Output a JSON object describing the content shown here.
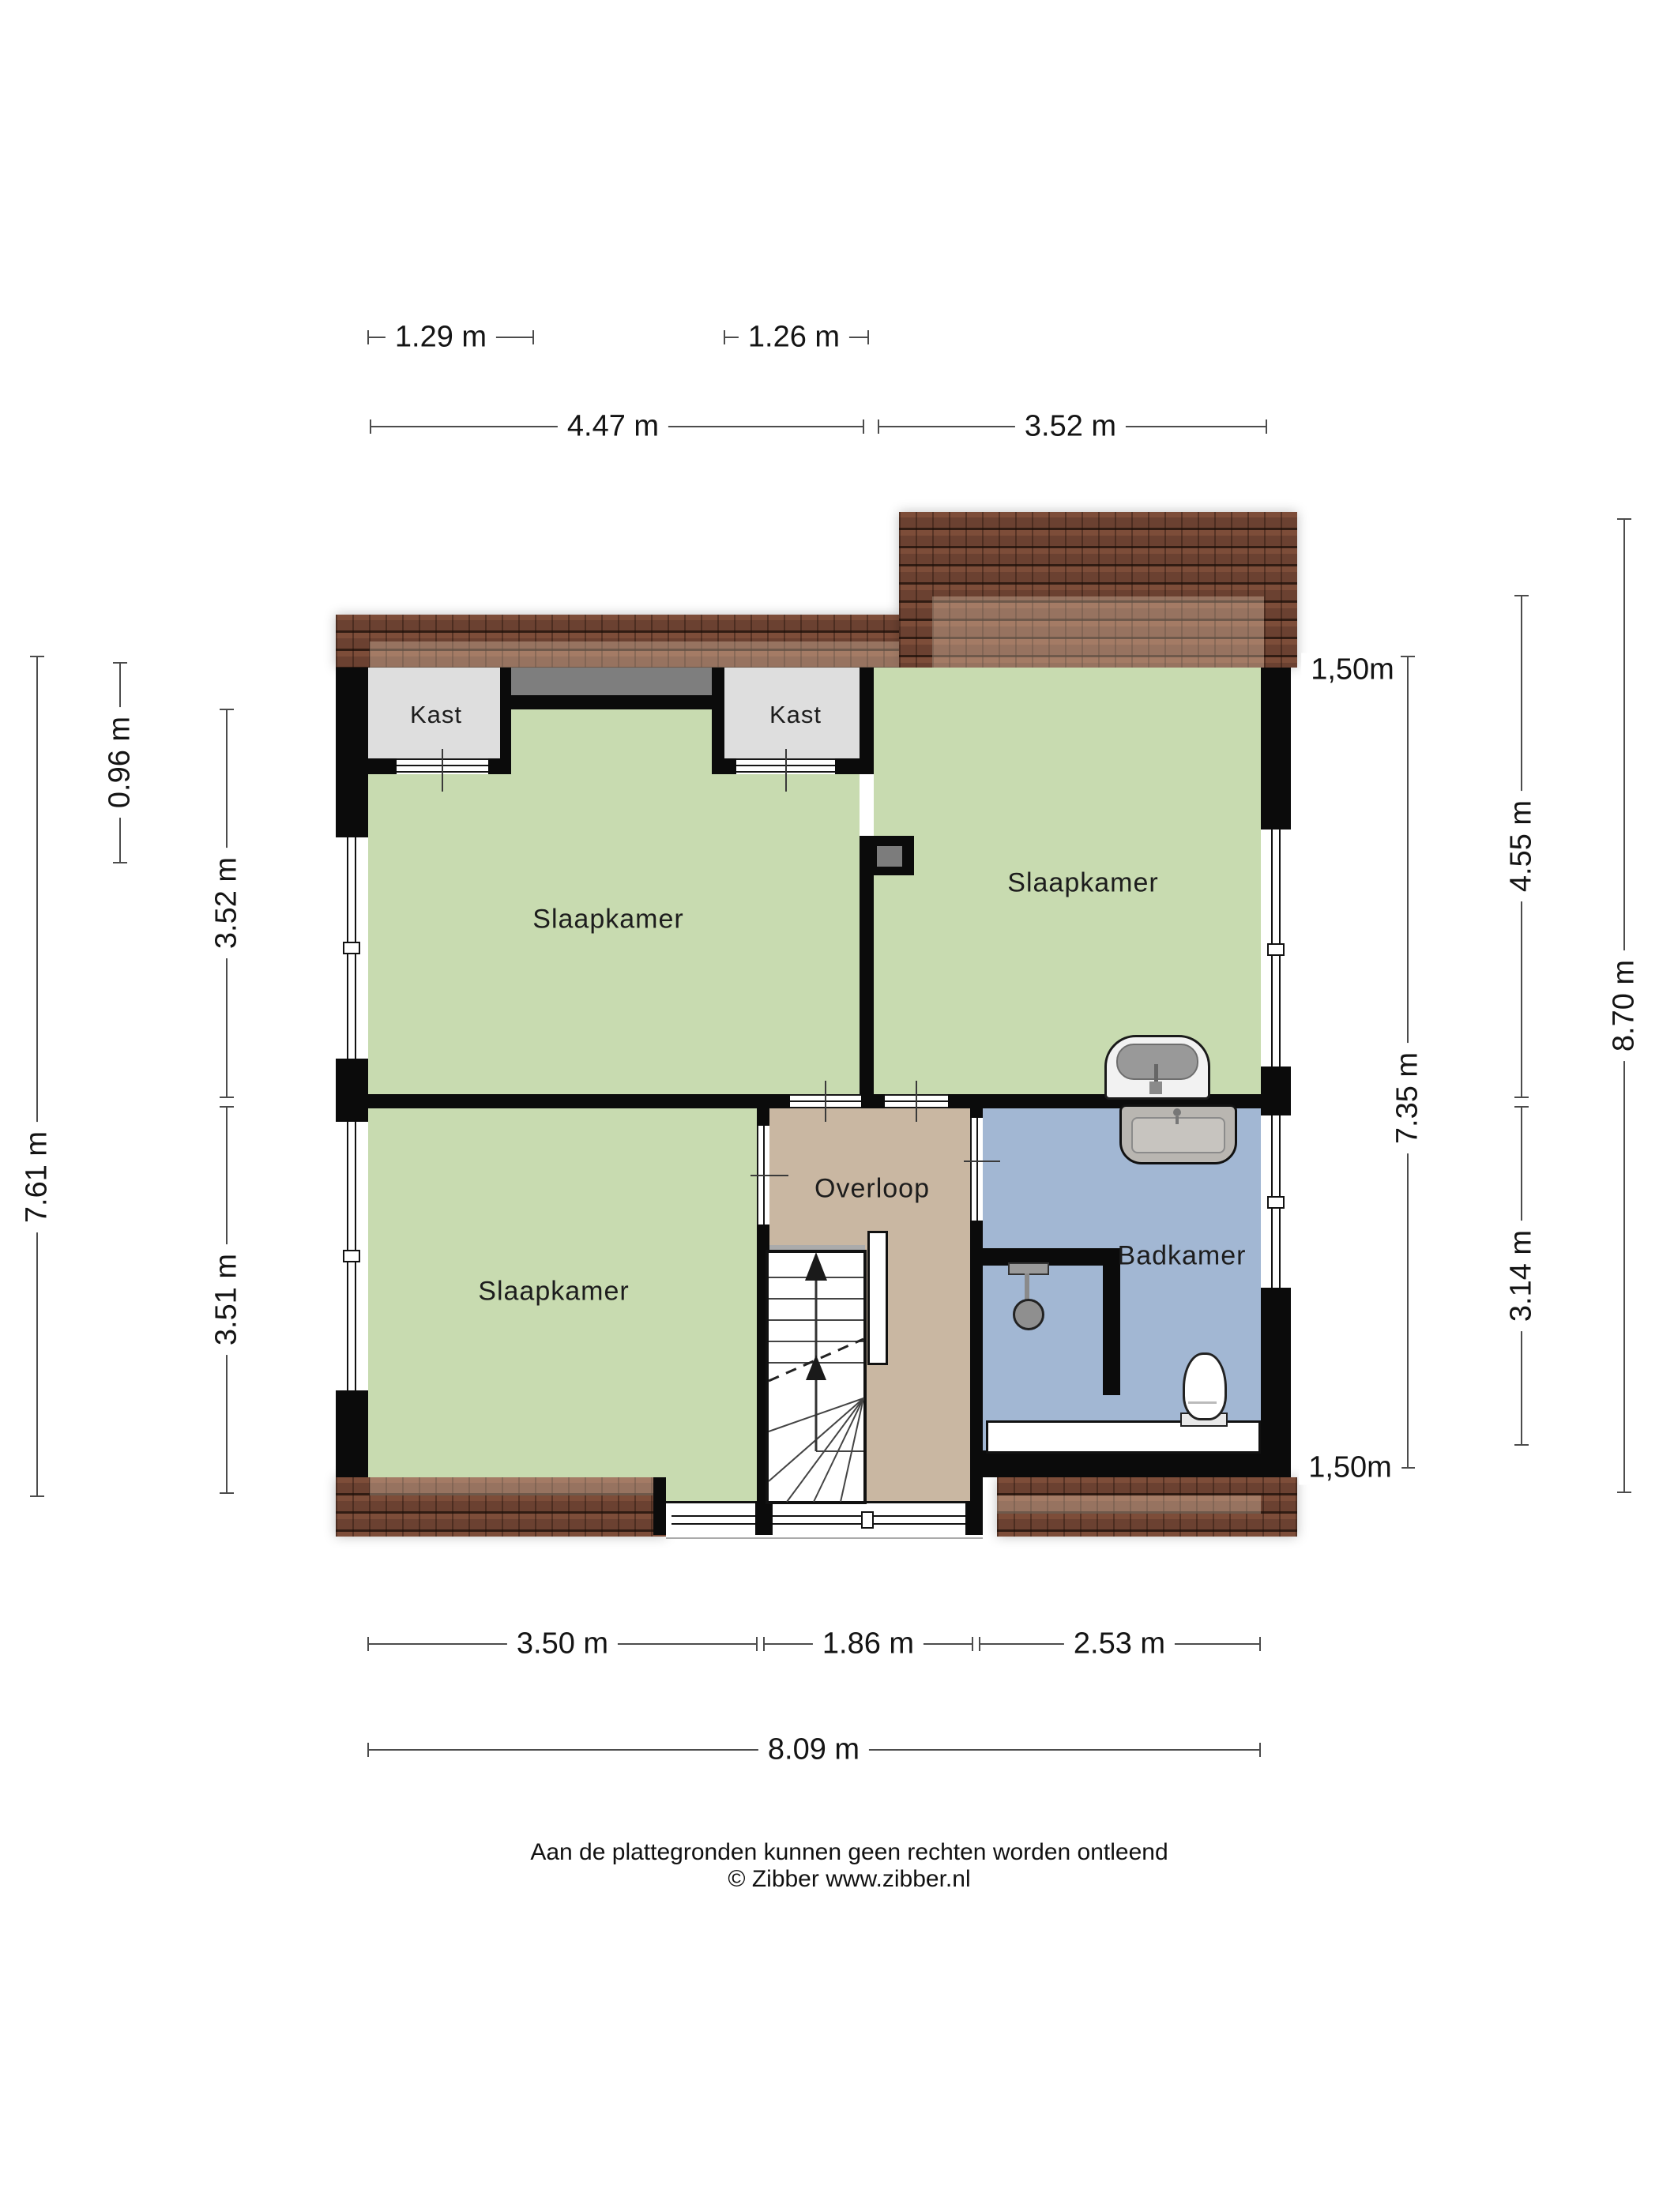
{
  "rooms": {
    "bedroom_tl": "Slaapkamer",
    "bedroom_tr": "Slaapkamer",
    "bedroom_bl": "Slaapkamer",
    "closet1": "Kast",
    "closet2": "Kast",
    "landing": "Overloop",
    "bathroom": "Badkamer"
  },
  "dimensions": {
    "top_inner": [
      "1.29 m",
      "1.26 m"
    ],
    "top": [
      "4.47 m",
      "3.52 m"
    ],
    "left": {
      "roof": "0.96 m",
      "upper": "3.52 m",
      "lower": "3.51 m",
      "total": "7.61 m"
    },
    "right": {
      "knee_top": "1,50m",
      "upper": "4.55 m",
      "mid": "7.35 m",
      "total": "8.70 m",
      "lower": "3.14 m",
      "knee_bottom": "1,50m"
    },
    "bottom": [
      "3.50 m",
      "1.86 m",
      "2.53 m"
    ],
    "bottom_total": "8.09 m"
  },
  "footer": {
    "disclaimer": "Aan de plattegronden kunnen geen rechten worden ontleend",
    "copyright": "© Zibber www.zibber.nl"
  },
  "icons": {
    "wash_basin": "wash-basin-icon",
    "vanity_sink": "vanity-sink-icon",
    "toilet": "toilet-icon",
    "shower": "shower-head-icon",
    "stairs": "staircase-icon",
    "chimney": "chimney-icon"
  },
  "colors": {
    "wall": "#0b0b0b",
    "bedroom_floor": "#c8dbb0",
    "landing_floor": "#c9b7a2",
    "bathroom_floor": "#a2b7d3",
    "closet_floor": "#dedede",
    "roof_tiles": "#6f4434",
    "recess": "#7e7e7e",
    "dimension_lines": "#4c4c4c"
  }
}
